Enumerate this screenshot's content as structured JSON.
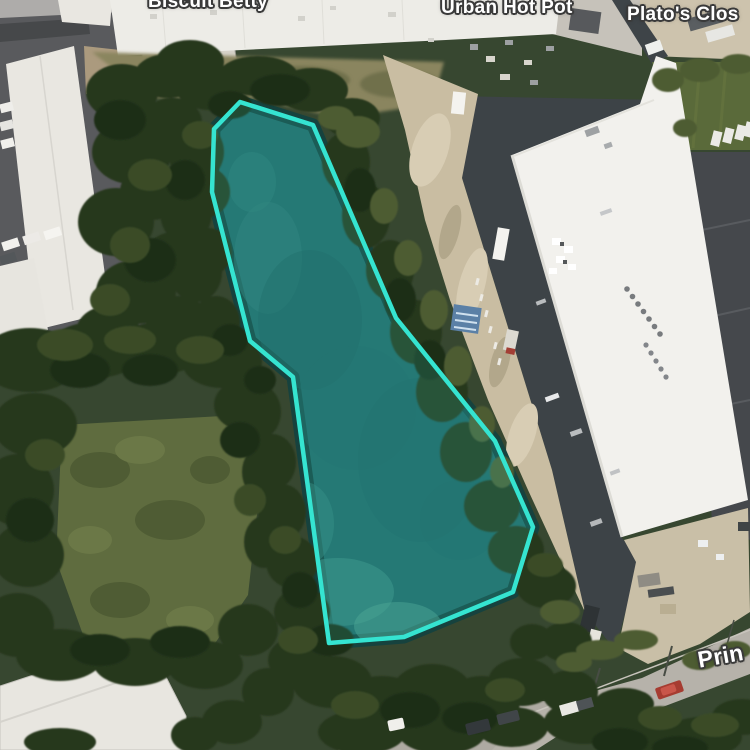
{
  "map": {
    "view_type": "satellite",
    "labels": {
      "place_top_left": "Biscuit Betty",
      "place_top_center": "Urban Hot Pot",
      "place_top_right": "Plato's Clos",
      "road_bottom_right": "Prin"
    },
    "selection": {
      "points": [
        [
          240,
          102
        ],
        [
          214,
          129
        ],
        [
          212,
          192
        ],
        [
          250,
          341
        ],
        [
          293,
          377
        ],
        [
          329,
          643
        ],
        [
          404,
          637
        ],
        [
          513,
          592
        ],
        [
          533,
          527
        ],
        [
          495,
          441
        ],
        [
          396,
          318
        ],
        [
          313,
          125
        ]
      ],
      "stroke_color": "#35e4d1",
      "fill_color": "rgba(53,228,209,0.16)"
    },
    "palette": {
      "pond_water": "#226564",
      "trees_dark": "#27371e",
      "grass": "#5f6c3f",
      "dirt": "#c9bda2",
      "roof_white": "#f0efeb",
      "asphalt_dark": "#45484c",
      "road_gray": "#b6b2aa"
    }
  }
}
